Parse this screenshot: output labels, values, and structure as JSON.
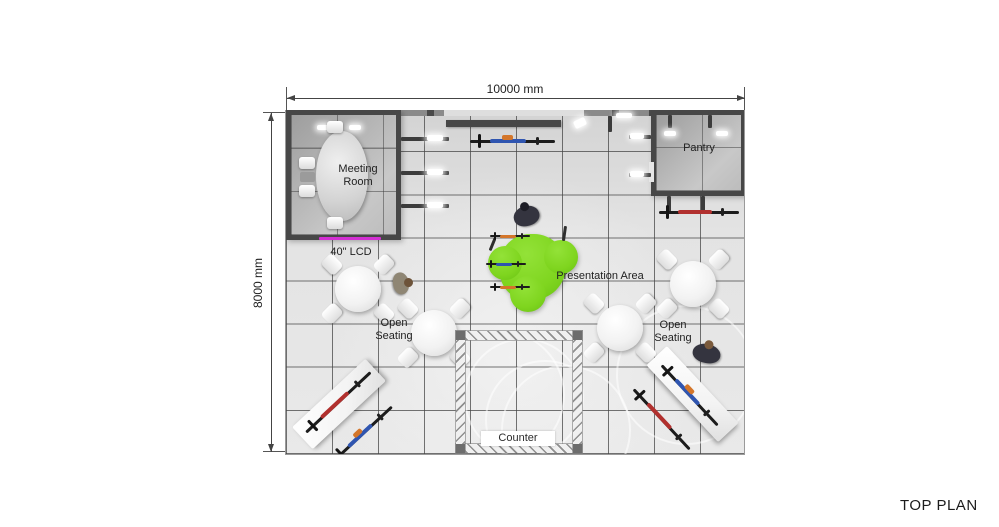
{
  "plan": {
    "title": "TOP PLAN",
    "dimension_top": "10000 mm",
    "dimension_left": "8000 mm",
    "rooms": {
      "meeting_room": "Meeting Room",
      "pantry": "Pantry"
    },
    "annotations": {
      "lcd": "40\" LCD",
      "presentation_area": "Presentation Area",
      "open_seating_left": "Open Seating",
      "open_seating_right": "Open Seating",
      "counter": "Counter"
    },
    "colors": {
      "wall_dark": "#474747",
      "floor_light": "#e7e7e7",
      "presentation_green": "#7fd51f",
      "lcd_magenta": "#d32fd3",
      "bike_red": "#b1302e",
      "bike_blue": "#2f55b0",
      "accent_orange": "#d4762a"
    }
  }
}
